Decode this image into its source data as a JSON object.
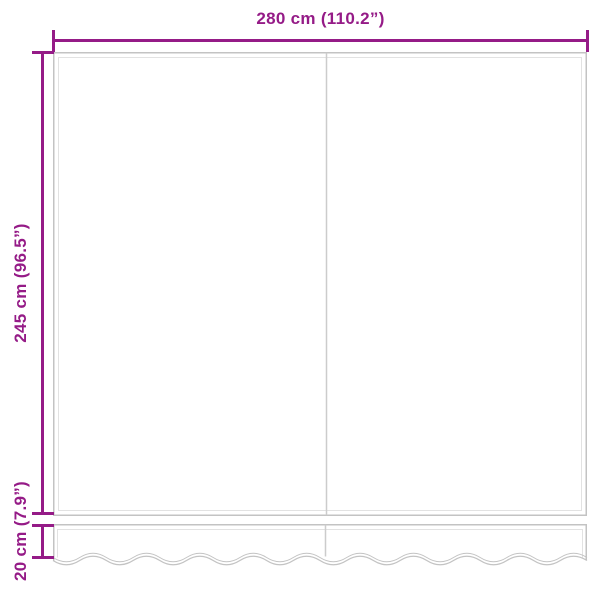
{
  "diagram": {
    "background": "#ffffff",
    "accent_color": "#951b87",
    "outline_color": "#c3c3c3",
    "outline_inner_color": "#e2e2e2",
    "seam_color": "#cccccc",
    "labels": {
      "width": "280 cm (110.2”)",
      "height": "245 cm (96.5”)",
      "valance_height": "20 cm (7.9”)"
    }
  }
}
